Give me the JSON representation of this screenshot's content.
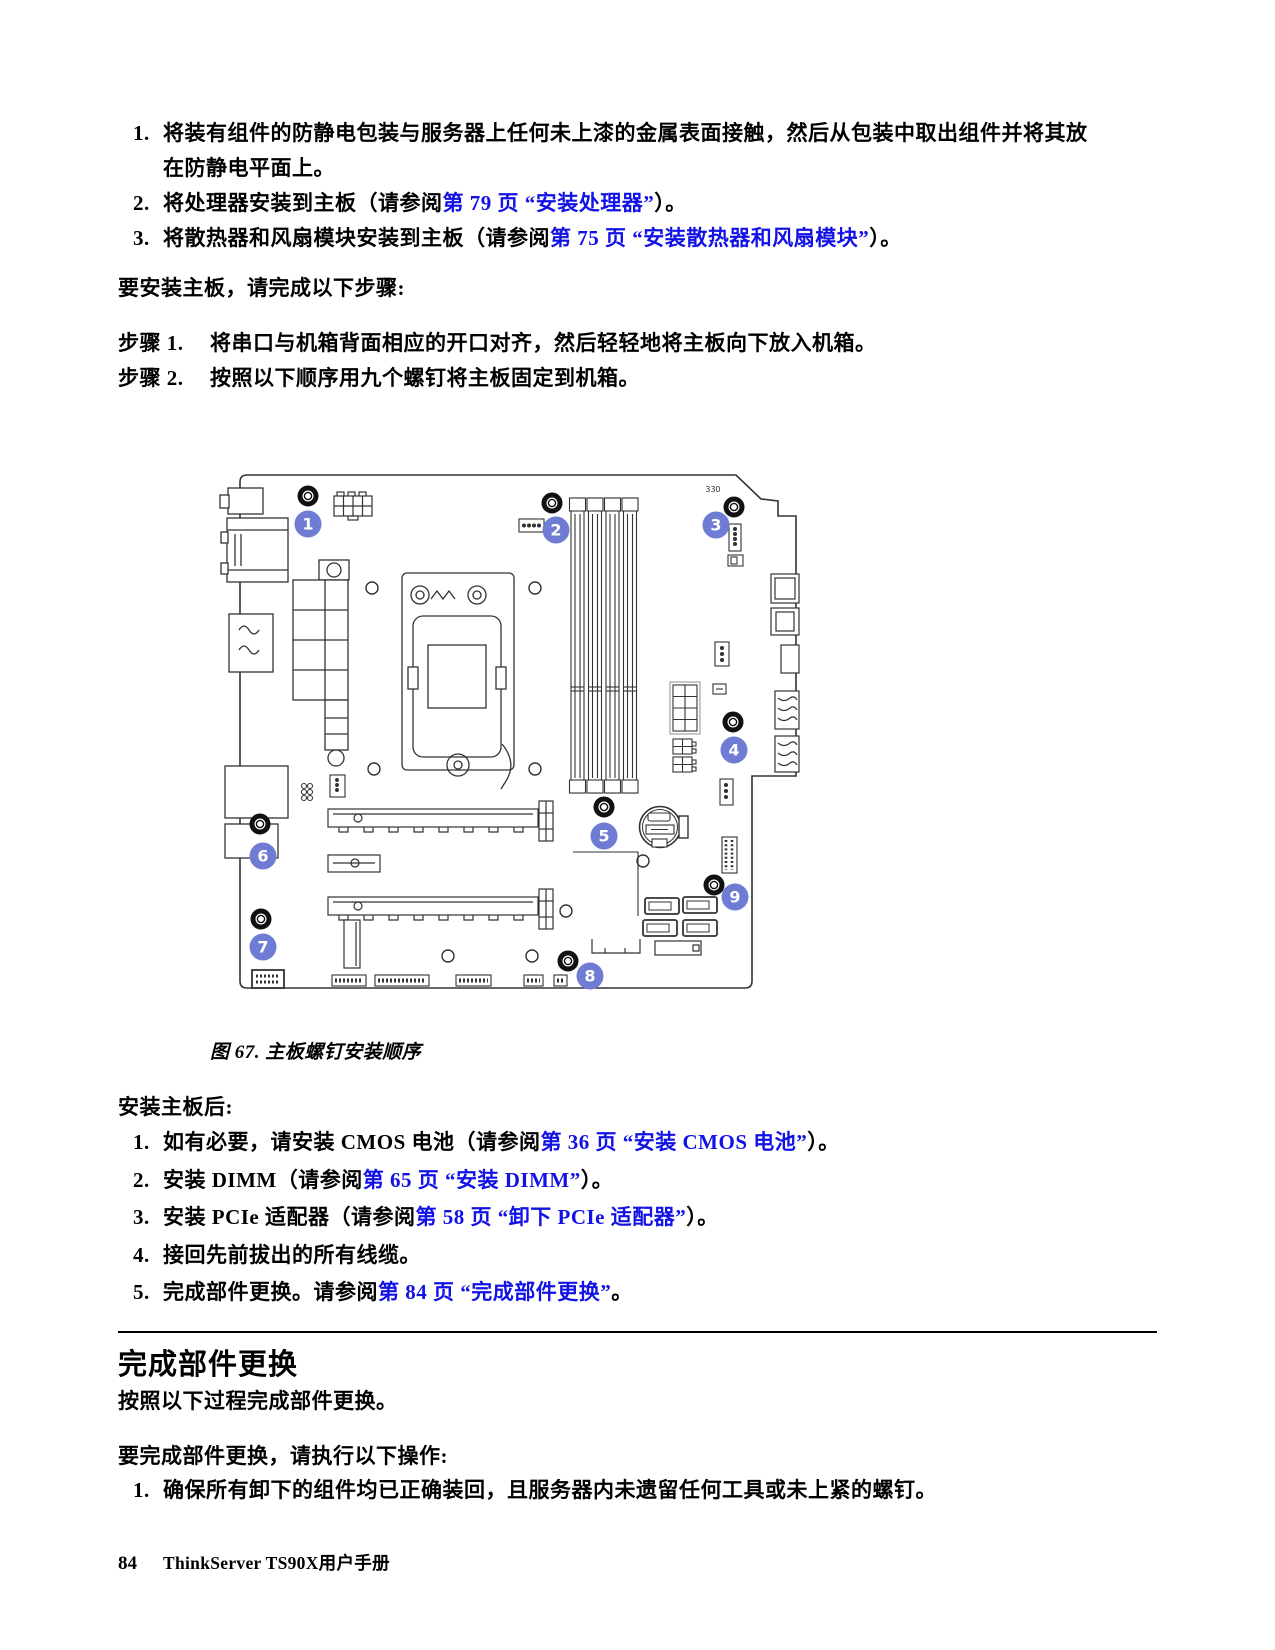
{
  "top_list": [
    {
      "num": "1.",
      "segments": [
        {
          "text": "将装有组件的防静电包装与服务器上任何未上漆的金属表面接触，然后从包装中取出组件并将其放在防静电平面上。",
          "link": false
        }
      ]
    },
    {
      "num": "2.",
      "segments": [
        {
          "text": "将处理器安装到主板（请参阅",
          "link": false
        },
        {
          "text": "第 79 页 “安装处理器”",
          "link": true
        },
        {
          "text": "）。",
          "link": false
        }
      ]
    },
    {
      "num": "3.",
      "segments": [
        {
          "text": "将散热器和风扇模块安装到主板（请参阅",
          "link": false
        },
        {
          "text": "第 75 页 “安装散热器和风扇模块”",
          "link": true
        },
        {
          "text": "）。",
          "link": false
        }
      ]
    }
  ],
  "install_intro": "要安装主板，请完成以下步骤:",
  "steps": [
    {
      "label": "步骤 1.",
      "text": "将串口与机箱背面相应的开口对齐，然后轻轻地将主板向下放入机箱。"
    },
    {
      "label": "步骤 2.",
      "text": "按照以下顺序用九个螺钉将主板固定到机箱。"
    }
  ],
  "figure": {
    "caption": "图 67. 主板螺钉安装顺序"
  },
  "diagram": {
    "callouts": [
      "1",
      "2",
      "3",
      "4",
      "5",
      "6",
      "7",
      "8",
      "9"
    ],
    "silkscreen": "330",
    "callout_color": "#6e7cd4",
    "screw_count": "9"
  },
  "after_heading": "安装主板后:",
  "after_list": [
    {
      "num": "1.",
      "segments": [
        {
          "text": "如有必要，请安装 CMOS 电池（请参阅",
          "link": false
        },
        {
          "text": "第 36 页 “安装 CMOS 电池”",
          "link": true
        },
        {
          "text": "）。",
          "link": false
        }
      ]
    },
    {
      "num": "2.",
      "segments": [
        {
          "text": "安装 DIMM（请参阅",
          "link": false
        },
        {
          "text": "第 65 页 “安装 DIMM”",
          "link": true
        },
        {
          "text": "）。",
          "link": false
        }
      ]
    },
    {
      "num": "3.",
      "segments": [
        {
          "text": "安装 PCIe 适配器（请参阅",
          "link": false
        },
        {
          "text": "第 58 页 “卸下 PCIe 适配器”",
          "link": true
        },
        {
          "text": "）。",
          "link": false
        }
      ]
    },
    {
      "num": "4.",
      "segments": [
        {
          "text": "接回先前拔出的所有线缆。",
          "link": false
        }
      ]
    },
    {
      "num": "5.",
      "segments": [
        {
          "text": "完成部件更换。请参阅",
          "link": false
        },
        {
          "text": "第 84 页 “完成部件更换”",
          "link": true
        },
        {
          "text": "。",
          "link": false
        }
      ]
    }
  ],
  "section": {
    "title": "完成部件更换",
    "lead": "按照以下过程完成部件更换。",
    "intro": "要完成部件更换，请执行以下操作:",
    "list": [
      {
        "num": "1.",
        "segments": [
          {
            "text": "确保所有卸下的组件均已正确装回，且服务器内未遗留任何工具或未上紧的螺钉。",
            "link": false
          }
        ]
      }
    ]
  },
  "footer": {
    "page_number": "84",
    "doc_title": "ThinkServer TS90X用户手册"
  },
  "colors": {
    "link_blue": "#1212e6",
    "callout_blue": "#6e7cd4",
    "line": "#333333"
  }
}
